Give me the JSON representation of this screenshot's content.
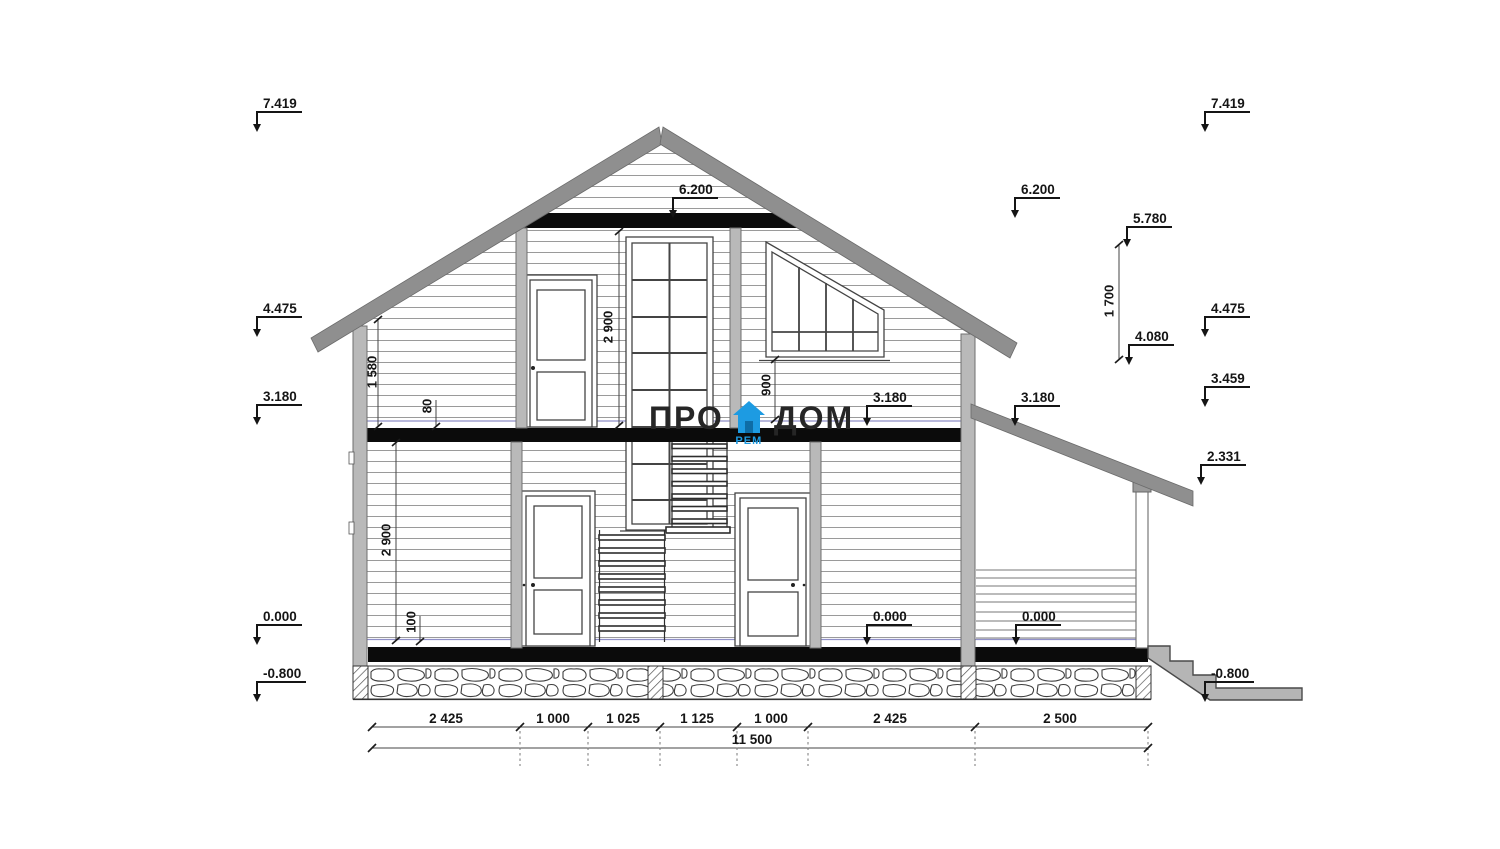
{
  "watermark": {
    "left": "ПРО",
    "right": "ДОМ",
    "sub": "РЕМ",
    "brand_blue": "#1d9be2"
  },
  "elevations": {
    "left_column": [
      "7.419",
      "4.475",
      "3.180",
      "0.000",
      "-0.800"
    ],
    "right_column": [
      "7.419",
      "4.475",
      "3.459",
      "2.331",
      "-0.800"
    ],
    "right_mid": [
      "6.200",
      "5.780",
      "4.080",
      "3.180"
    ],
    "interior": [
      "6.200",
      "3.180",
      "0.000",
      "0.000"
    ]
  },
  "dims": {
    "vertical": {
      "attic_knee": "1 580",
      "finish_gap": "80",
      "floor1_height": "2 900",
      "floor_thickness": "100",
      "floor2_height": "2 900",
      "sill_height": "900",
      "roof_rise": "1 700"
    },
    "chain": [
      "2 425",
      "1 000",
      "1 025",
      "1 125",
      "1 000",
      "2 425",
      "2 500"
    ],
    "total": "11 500"
  }
}
